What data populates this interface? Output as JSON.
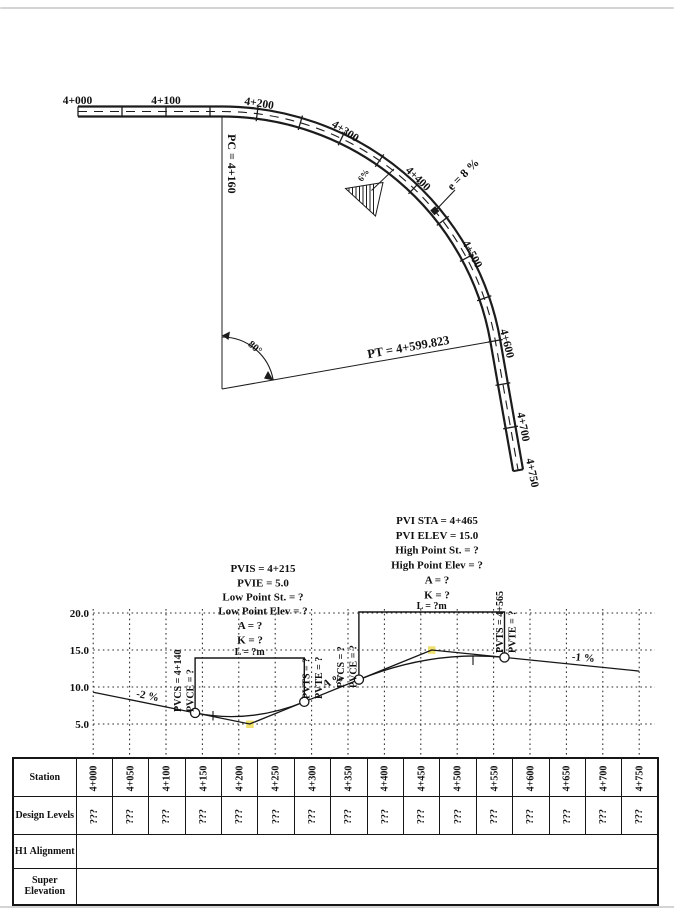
{
  "plan": {
    "stations_tangent": [
      "4+000",
      "4+100",
      "4+200"
    ],
    "stations_curve": [
      "4+300",
      "4+400",
      "4+500",
      "4+600",
      "4+700",
      "4+750"
    ],
    "pc_label": "PC = 4+160",
    "pt_label": "PT = 4+599.823",
    "central_angle": "80°",
    "superelevation": "e = 8 %",
    "side_slope": "6%"
  },
  "profile": {
    "elev_ticks": [
      "20.0",
      "15.0",
      "10.0",
      "5.0"
    ],
    "sag": [
      "PVIS = 4+215",
      "PVIE = 5.0",
      "Low Point St. = ?",
      "Low Point Elev = ?",
      "A = ?",
      "K = ?",
      "L = ?m"
    ],
    "crest": [
      "PVI STA = 4+465",
      "PVI ELEV = 15.0",
      "High Point St. = ?",
      "High Point Elev = ?",
      "A = ?",
      "K = ?",
      "L = ?m"
    ],
    "pvc1": [
      "PVCS = 4+140",
      "PVCE = ?"
    ],
    "pvt1": [
      "PVTS = ?",
      "PVTE = ?"
    ],
    "pvc2": [
      "PVCS = ?",
      "PVCE = ?"
    ],
    "pvt2": [
      "PVTS = 4+565",
      "PVTE = ?"
    ],
    "grade_in": "-2 %",
    "grade_mid": "A %",
    "grade_out": "-1 %"
  },
  "chart_data": {
    "type": "line",
    "title": "Vertical profile (design grade line)",
    "xlabel": "Station",
    "ylabel": "Elevation (m)",
    "ylim": [
      5,
      20
    ],
    "grid": true,
    "x_ticks": [
      "4+000",
      "4+050",
      "4+100",
      "4+150",
      "4+200",
      "4+250",
      "4+300",
      "4+350",
      "4+400",
      "4+450",
      "4+500",
      "4+550",
      "4+600",
      "4+650",
      "4+700",
      "4+750"
    ],
    "series": [
      {
        "name": "tangent grade lines",
        "x": [
          "4+000",
          "4+140",
          "4+215",
          "4+290",
          "4+365",
          "4+465",
          "4+565",
          "4+750"
        ],
        "y": [
          9.3,
          6.5,
          5.0,
          8.0,
          11.0,
          15.0,
          14.0,
          12.15
        ]
      },
      {
        "name": "sag vertical curve (PVC 4+140 to PVT 4+290, PVI 4+215 elev 5.0)",
        "x": [
          "4+140",
          "4+290"
        ],
        "y": [
          6.5,
          8.0
        ]
      },
      {
        "name": "crest vertical curve (PVC 4+365 to PVT 4+565, PVI 4+465 elev 15.0)",
        "x": [
          "4+365",
          "4+565"
        ],
        "y": [
          11.0,
          14.0
        ]
      }
    ],
    "annotations": [
      "-2 %",
      "A %",
      "-1 %",
      "L = ?m",
      "L = ?m"
    ]
  },
  "table": {
    "row_headers": [
      "Station",
      "Design Levels",
      "H1 Alignment",
      "Super Elevation"
    ],
    "stations": [
      "4+000",
      "4+050",
      "4+100",
      "4+150",
      "4+200",
      "4+250",
      "4+300",
      "4+350",
      "4+400",
      "4+450",
      "4+500",
      "4+550",
      "4+600",
      "4+650",
      "4+700",
      "4+750"
    ],
    "design_levels": [
      "???",
      "???",
      "???",
      "???",
      "???",
      "???",
      "???",
      "???",
      "???",
      "???",
      "???",
      "???",
      "???",
      "???",
      "???",
      "???"
    ]
  }
}
